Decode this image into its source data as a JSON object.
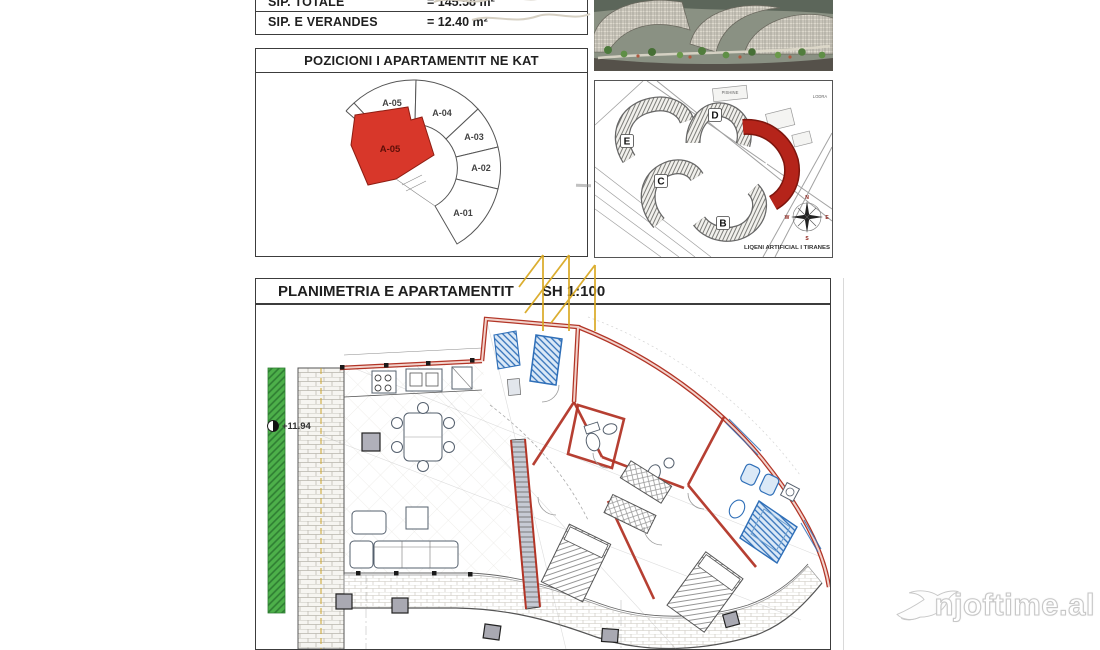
{
  "colors": {
    "red_highlight": "#d8372a",
    "red_dark": "#b5241a",
    "wall_red": "#b23527",
    "wall_fill": "#f2d3cc",
    "green": "#4db04a",
    "green_dark": "#2e7d32",
    "blue": "#2f6fb8",
    "blue_fill": "#dbe9f7",
    "yellow": "#d9a820",
    "ink": "#1f1f1f"
  },
  "summary_table": {
    "rows": [
      {
        "label": "SIP. TOTALE",
        "value": "= 145.58 m²"
      },
      {
        "label": "SIP. E VERANDES",
        "value": "= 12.40 m²"
      }
    ]
  },
  "position_panel": {
    "title": "POZICIONI I APARTAMENTIT NE KAT",
    "sector_labels": [
      "A-05",
      "A-04",
      "A-03",
      "A-02",
      "A-01"
    ],
    "highlighted_unit": "A-05"
  },
  "site_panel": {
    "building_labels": [
      "E",
      "D",
      "C",
      "B"
    ],
    "highlighted_building": "A",
    "area_labels": {
      "pool": "PISHINE",
      "playground": "LODRA",
      "lake": "LIQENI ARTIFICIAL I TIRANES"
    },
    "compass": {
      "n": "N",
      "e": "E",
      "s": "S",
      "w": "W"
    }
  },
  "plan_panel": {
    "title": "PLANIMETRIA E APARTAMENTIT",
    "scale": "SH 1:100",
    "elevation": "+11.94"
  },
  "brand": {
    "name": "njoftime.al"
  }
}
